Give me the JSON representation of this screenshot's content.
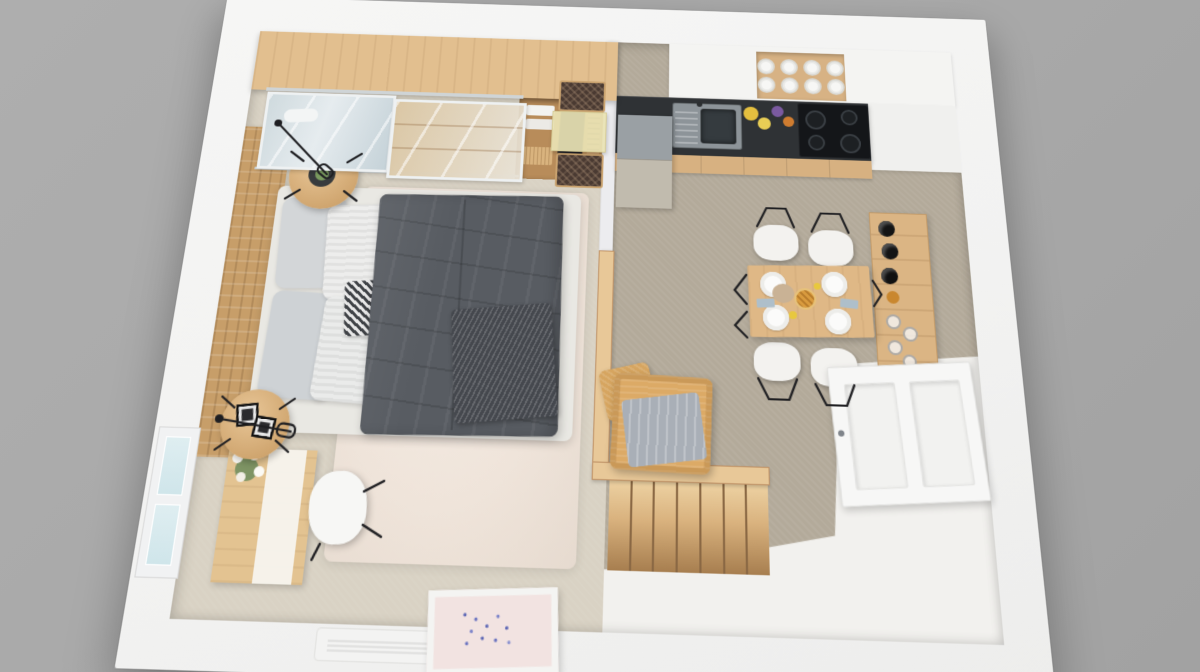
{
  "scene": {
    "title": "3D rendered top-down floor plan of a studio apartment",
    "view": "overhead dollhouse render, slightly rotated with perspective",
    "background_color": "#a8a8a8",
    "wall_color": "#f5f5f4",
    "rooms": [
      {
        "name": "bedroom",
        "floor_description": "beige carpet with cream shag rug",
        "floor_color": "#d9d2c4",
        "rug_color": "#efe5dc",
        "furniture": [
          "wardrobe with wood top and sliding mirror doors",
          "open closet shelves with folded linens, hanging dark garments, basket and shoe rack",
          "dressing table with glass top and two dark upholstered stools",
          "woven wood bench along left wall",
          "two black wire floor lamps",
          "round wood side table with plant tray",
          "round wood side table with two photo frames",
          "double bed with white mattress, gray and striped pillows, houndstooth accent pillow",
          "dark gray duvet with knit throw",
          "wood writing desk with white runner and flower vase",
          "white shell desk chair",
          "window in left wall",
          "white radiator vent in bottom wall",
          "framed lavender artwork leaning on bottom wall"
        ]
      },
      {
        "name": "kitchen-dining",
        "floor_description": "taupe carpet",
        "floor_color": "#b3aa9a",
        "furniture": [
          "white upper cabinets along top wall",
          "open shelf recess with eight white cups",
          "colored spice jars and bottles on counter",
          "refrigerator with gray top",
          "dark countertop with stainless sink and drainboard",
          "black induction cooktop with four burners",
          "wood base cabinets",
          "wood dining table set for four with plates, napkins, pie and centerpiece",
          "four white shell chairs with black wire legs",
          "wood wine and glassware rack on right wall",
          "tan woven armchair with gray blanket",
          "woven ottoman"
        ]
      },
      {
        "name": "entry-landing",
        "floor_description": "white lower landing",
        "floor_color": "#f2f1ee",
        "furniture": [
          "wood staircase with railing descending from living level",
          "white paneled entry door"
        ]
      }
    ],
    "palette": {
      "wood_light": "#e2bf8f",
      "wood_mid": "#dbb584",
      "duvet_gray": "#585c62",
      "counter_dark": "#2f3235",
      "armchair_tan": "#dcaa66",
      "chair_white": "#f3f2ef",
      "stool_dark": "#4a3a32",
      "blanket_gray": "#a9afb7"
    }
  }
}
